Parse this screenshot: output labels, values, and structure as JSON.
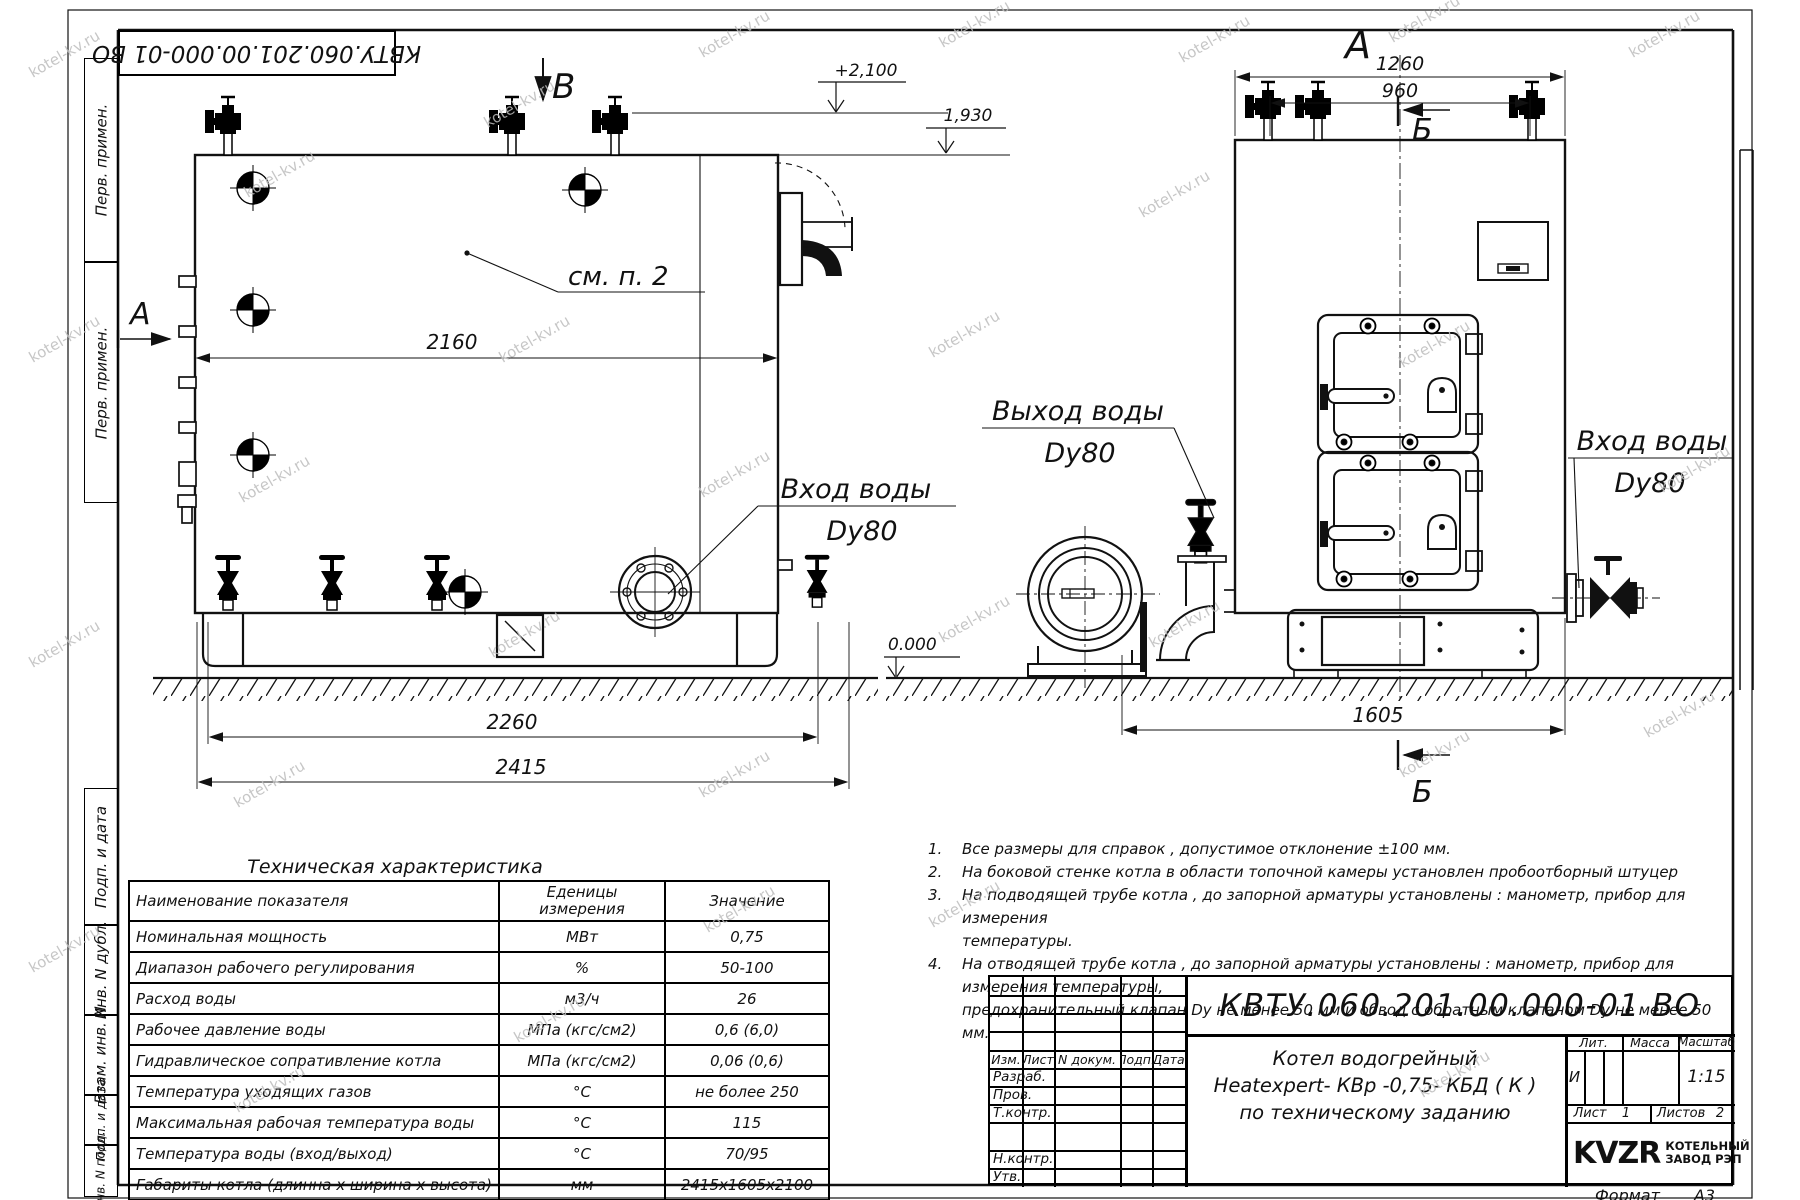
{
  "watermark": "kotel-kv.ru",
  "frame": {
    "stamp": "КВТУ.060.201.00.000-01 ВО",
    "format_label": "Формат",
    "format_value": "А3",
    "margin_top": [
      "Перв. примен.",
      "Перв. примен."
    ],
    "margin_bottom": [
      "Подп. и дата",
      "Инв. N дубл.",
      "Взам. инв. N",
      "Подп. и дата",
      "Инв. N подл."
    ]
  },
  "drawing": {
    "side_view": {
      "letter_b": "В",
      "letter_a": "А",
      "see_note": "см. п. 2",
      "dim_body": "2160",
      "dim_frame": "2260",
      "dim_total": "2415",
      "lvl_top": "+2,100",
      "lvl_shell": "1,930",
      "lvl_zero": "0.000",
      "inlet_line1": "Вход воды",
      "inlet_line2": "Dy80"
    },
    "front_view": {
      "letter_a": "А",
      "letter_b_top": "Б",
      "letter_b_bottom": "Б",
      "dim_width": "1260",
      "dim_valves": "960",
      "dim_depth": "1605",
      "outlet_line1": "Выход воды",
      "outlet_line2": "Dy80",
      "inlet_line1": "Вход воды",
      "inlet_line2": "Dy80"
    }
  },
  "notes": [
    {
      "num": "1.",
      "lines": [
        "Все размеры для справок , допустимое отклонение  ±100 мм."
      ]
    },
    {
      "num": "2.",
      "lines": [
        "На боковой стенке котла в области топочной камеры установлен пробоотборный штуцер"
      ]
    },
    {
      "num": "3.",
      "lines": [
        "На  подводящей трубе котла , до запорной арматуры установлены :  манометр, прибор для измерения",
        "температуры."
      ]
    },
    {
      "num": "4.",
      "lines": [
        "На отводящей трубе котла , до запорной арматуры установлены :  манометр, прибор для измерения температуры,",
        "предохранительный клапан  Dу не менее  50 мм и обвод с обратным клапаном  Dу не менее  50 мм."
      ]
    }
  ],
  "tech_table": {
    "title": "Техническая характеристика",
    "headers": {
      "name": "Наименование показателя",
      "unit1": "Еденицы",
      "unit2": "измерения",
      "value": "Значение"
    },
    "rows": [
      {
        "name": "Номинальная мощность",
        "unit": "МВт",
        "value": "0,75"
      },
      {
        "name": "Диапазон рабочего регулирования",
        "unit": "%",
        "value": "50-100"
      },
      {
        "name": "Расход воды",
        "unit": "м3/ч",
        "value": "26"
      },
      {
        "name": "Рабочее давление воды",
        "unit": "МПа (кгс/см2)",
        "value": "0,6 (6,0)"
      },
      {
        "name": "Гидравлическое сопративление котла",
        "unit": "МПа (кгс/см2)",
        "value": "0,06 (0,6)"
      },
      {
        "name": "Температура уходящих газов",
        "unit": "°С",
        "value": "не более 250"
      },
      {
        "name": "Максимальная рабочая температура воды",
        "unit": "°С",
        "value": "115"
      },
      {
        "name": "Температура воды (вход/выход)",
        "unit": "°С",
        "value": "70/95"
      },
      {
        "name": "Габариты котла (длинна х ширина х высота)",
        "unit": "мм",
        "value": "2415х1605х2100"
      }
    ]
  },
  "title_block": {
    "doc_number": "КВТУ.060.201.00.000-01 ВО",
    "name_lines": [
      "Котел водогрейный",
      "Heatexpert- КВр -0,75- КБД ( К )",
      "по техническому заданию"
    ],
    "cols": [
      "Изм.",
      "Лист",
      "N докум.",
      "Подп.",
      "Дата"
    ],
    "sign_rows": [
      "Разраб.",
      "Пров.",
      "Т.контр.",
      "Н.контр.",
      "Утв."
    ],
    "lit_header": "Лит.",
    "mass_header": "Масса",
    "scale_header": "Масштаб",
    "lit_value": "И",
    "scale_value": "1:15",
    "sheet_label": "Лист",
    "sheet_value": "1",
    "sheets_label": "Листов",
    "sheets_value": "2",
    "logo_text": "KVZR",
    "company_line1": "КОТЕЛЬНЫЙ",
    "company_line2": "ЗАВОД РЭП"
  }
}
